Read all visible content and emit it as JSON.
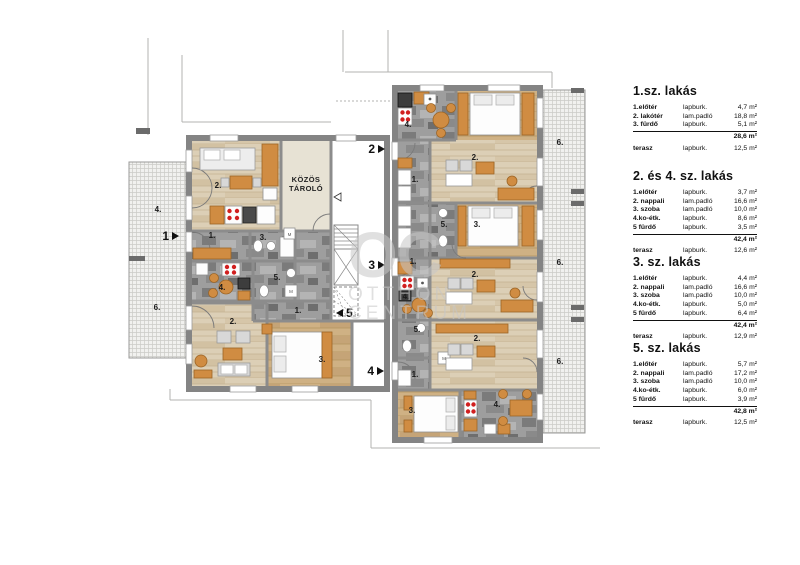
{
  "watermark": {
    "initials": "OC",
    "line1": "OTTHON",
    "line2": "CENTRUM"
  },
  "plan": {
    "common_storage_line1": "KÖZÖS",
    "common_storage_line2": "TÁROLÓ",
    "washer_label": "M",
    "entrances": [
      {
        "num": "1",
        "dir": "right",
        "x": 172,
        "y": 236
      },
      {
        "num": "2",
        "dir": "right",
        "x": 378,
        "y": 149
      },
      {
        "num": "3",
        "dir": "right",
        "x": 378,
        "y": 265
      },
      {
        "num": "4",
        "dir": "right",
        "x": 377,
        "y": 371
      },
      {
        "num": "5",
        "dir": "left",
        "x": 343,
        "y": 313
      }
    ],
    "room_labels": [
      {
        "t": "2.",
        "x": 218,
        "y": 188
      },
      {
        "t": "4.",
        "x": 158,
        "y": 212
      },
      {
        "t": "1.",
        "x": 212,
        "y": 238
      },
      {
        "t": "3.",
        "x": 263,
        "y": 240
      },
      {
        "t": "4.",
        "x": 222,
        "y": 290
      },
      {
        "t": "5.",
        "x": 277,
        "y": 280
      },
      {
        "t": "6.",
        "x": 157,
        "y": 310
      },
      {
        "t": "1.",
        "x": 298,
        "y": 313
      },
      {
        "t": "2.",
        "x": 233,
        "y": 324
      },
      {
        "t": "3.",
        "x": 322,
        "y": 362
      },
      {
        "t": "4.",
        "x": 408,
        "y": 127
      },
      {
        "t": "1.",
        "x": 415,
        "y": 182
      },
      {
        "t": "2.",
        "x": 475,
        "y": 160
      },
      {
        "t": "5.",
        "x": 444,
        "y": 227
      },
      {
        "t": "3.",
        "x": 477,
        "y": 227
      },
      {
        "t": "6.",
        "x": 560,
        "y": 145
      },
      {
        "t": "1.",
        "x": 413,
        "y": 264
      },
      {
        "t": "2.",
        "x": 475,
        "y": 277
      },
      {
        "t": "4.",
        "x": 406,
        "y": 299
      },
      {
        "t": "5.",
        "x": 417,
        "y": 332
      },
      {
        "t": "2.",
        "x": 477,
        "y": 341
      },
      {
        "t": "6.",
        "x": 560,
        "y": 265
      },
      {
        "t": "1.",
        "x": 415,
        "y": 377
      },
      {
        "t": "6.",
        "x": 560,
        "y": 364
      },
      {
        "t": "3.",
        "x": 412,
        "y": 413
      },
      {
        "t": "4.",
        "x": 497,
        "y": 407
      }
    ]
  },
  "listings": [
    {
      "title": "1.sz. lakás",
      "rows": [
        [
          "1.előtér",
          "lapburk.",
          "4,7 m²"
        ],
        [
          "2. lakótér",
          "lam.padló",
          "18,8 m²"
        ],
        [
          "3. fürdő",
          "lapburk.",
          "5,1 m²"
        ]
      ],
      "total": "28,6 m²",
      "terrace": [
        "terasz",
        "lapburk.",
        "12,5 m²"
      ]
    },
    {
      "title": "2. és 4. sz. lakás",
      "rows": [
        [
          "1.előtér",
          "lapburk.",
          "3,7 m²"
        ],
        [
          "2. nappali",
          "lam.padló",
          "16,6 m²"
        ],
        [
          "3. szoba",
          "lam.padló",
          "10,0 m²"
        ],
        [
          "4.ko-étk.",
          "lapburk.",
          "8,6 m²"
        ],
        [
          "5 fürdő",
          "lapburk.",
          "3,5 m²"
        ]
      ],
      "total": "42,4 m²",
      "terrace": [
        "terasz",
        "lapburk.",
        "12,6 m²"
      ]
    },
    {
      "title": "3. sz. lakás",
      "rows": [
        [
          "1.előtér",
          "lapburk.",
          "4,4 m²"
        ],
        [
          "2. nappali",
          "lam.padló",
          "16,6 m²"
        ],
        [
          "3. szoba",
          "lam.padló",
          "10,0 m²"
        ],
        [
          "4.ko-étk.",
          "lapburk.",
          "5,0 m²"
        ],
        [
          "5 fürdő",
          "lapburk.",
          "6,4 m²"
        ]
      ],
      "total": "42,4 m²",
      "terrace": [
        "terasz",
        "lapburk.",
        "12,9 m²"
      ]
    },
    {
      "title": "5. sz. lakás",
      "rows": [
        [
          "1.előtér",
          "lapburk.",
          "5,7 m²"
        ],
        [
          "2. nappali",
          "lam.padló",
          "17,2 m²"
        ],
        [
          "3. szoba",
          "lam.padló",
          "10,0 m²"
        ],
        [
          "4.ko-étk.",
          "lapburk.",
          "6,0 m²"
        ],
        [
          "5 fürdő",
          "lapburk.",
          "3,9 m²"
        ]
      ],
      "total": "42,8 m²",
      "terrace": [
        "terasz",
        "lapburk.",
        "12,5 m²"
      ]
    }
  ]
}
